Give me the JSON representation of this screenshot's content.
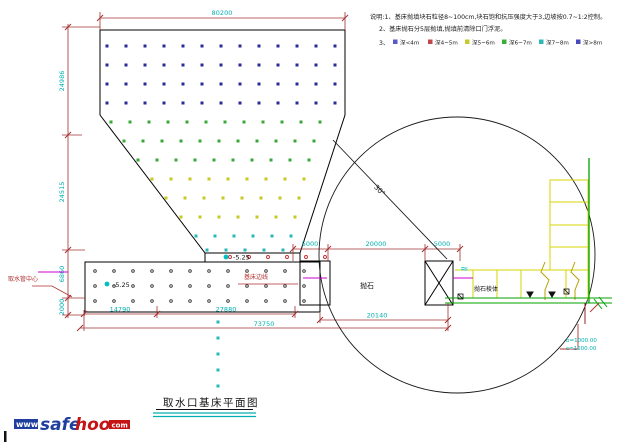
{
  "title": "取水口基床平面图",
  "notes": {
    "line1": "说明:1、基床抛填块石粒径8~100cm,块石饱和抗压强度大于3,边坡按0.7~1:2控制。",
    "line2": "2、基床抛石分5层抛填,抛填前清除口门浮泥。",
    "legend_prefix": "3、",
    "legend": [
      {
        "color": "#5858c8",
        "label": "深<4m"
      },
      {
        "color": "#c04848",
        "label": "深4~5m"
      },
      {
        "color": "#c8c830",
        "label": "深5~6m"
      },
      {
        "color": "#38b038",
        "label": "深6~7m"
      },
      {
        "color": "#30b8b8",
        "label": "深7~8m"
      },
      {
        "color": "#4848c0",
        "label": "深>8m"
      }
    ]
  },
  "dims": {
    "top": "80200",
    "left": [
      "24986",
      "24515",
      "6860",
      "2000"
    ],
    "mid": [
      "5000",
      "20000",
      "5000"
    ],
    "bottom_row1": [
      "14790",
      "27880"
    ],
    "bottom_row2": "20140",
    "bottom_row3": "73750"
  },
  "labels": {
    "elev_a": "-5.25",
    "elev_b": "-5.25",
    "angle": "30°",
    "pipe_center": "取水管中心",
    "bed_edge": "基床边线",
    "fill_rock": "抛石",
    "rock_body": "抛石棱体",
    "wave": "≈",
    "b_value": "b=1000.00",
    "c_value": "c=1000.00"
  },
  "logo": {
    "www": "www",
    "safe": "safe",
    "hoo": "hoo",
    "com": "com"
  },
  "colors": {
    "dim_line": "#a03030",
    "dim_text": "#00b0b0",
    "outline": "#000000",
    "green_line": "#00a000",
    "yellow_line": "#d4d400",
    "magenta": "#cc00cc",
    "logo_blue": "#1f3f9f",
    "logo_red": "#c41414"
  },
  "dots": {
    "step": 19,
    "square_rows": [
      {
        "y": 46,
        "x1": 107,
        "x2": 340,
        "color": "#2a2a96"
      },
      {
        "y": 65,
        "x1": 107,
        "x2": 340,
        "color": "#2a2a96"
      },
      {
        "y": 84,
        "x1": 107,
        "x2": 340,
        "color": "#2a2a96"
      },
      {
        "y": 103,
        "x1": 107,
        "x2": 340,
        "color": "#2a2a96"
      },
      {
        "y": 122,
        "x1": 111,
        "x2": 337,
        "color": "#38a838"
      },
      {
        "y": 141,
        "x1": 124,
        "x2": 332,
        "color": "#38a838"
      },
      {
        "y": 160,
        "x1": 138,
        "x2": 327,
        "color": "#38a838"
      },
      {
        "y": 179,
        "x1": 152,
        "x2": 322,
        "color": "#c8c820"
      },
      {
        "y": 198,
        "x1": 166,
        "x2": 316,
        "color": "#c8c820"
      },
      {
        "y": 217,
        "x1": 181,
        "x2": 310,
        "color": "#c8c820"
      },
      {
        "y": 236,
        "x1": 196,
        "x2": 304,
        "color": "#28b8b8"
      },
      {
        "y": 250,
        "x1": 207,
        "x2": 299,
        "color": "#28b8b8"
      }
    ],
    "circle_rows": [
      {
        "y": 257,
        "x1": 230,
        "x2": 330,
        "color": "#c03030",
        "r": 1.5
      },
      {
        "y": 271,
        "x1": 95,
        "x2": 313,
        "color": "#303030",
        "r": 1.3
      },
      {
        "y": 286,
        "x1": 95,
        "x2": 313,
        "color": "#303030",
        "r": 1.3
      },
      {
        "y": 301,
        "x1": 95,
        "x2": 313,
        "color": "#303030",
        "r": 1.3
      }
    ],
    "drop_column": {
      "x": 218,
      "ys": [
        322,
        338,
        354,
        370,
        386
      ],
      "color": "#28b8b8"
    }
  }
}
